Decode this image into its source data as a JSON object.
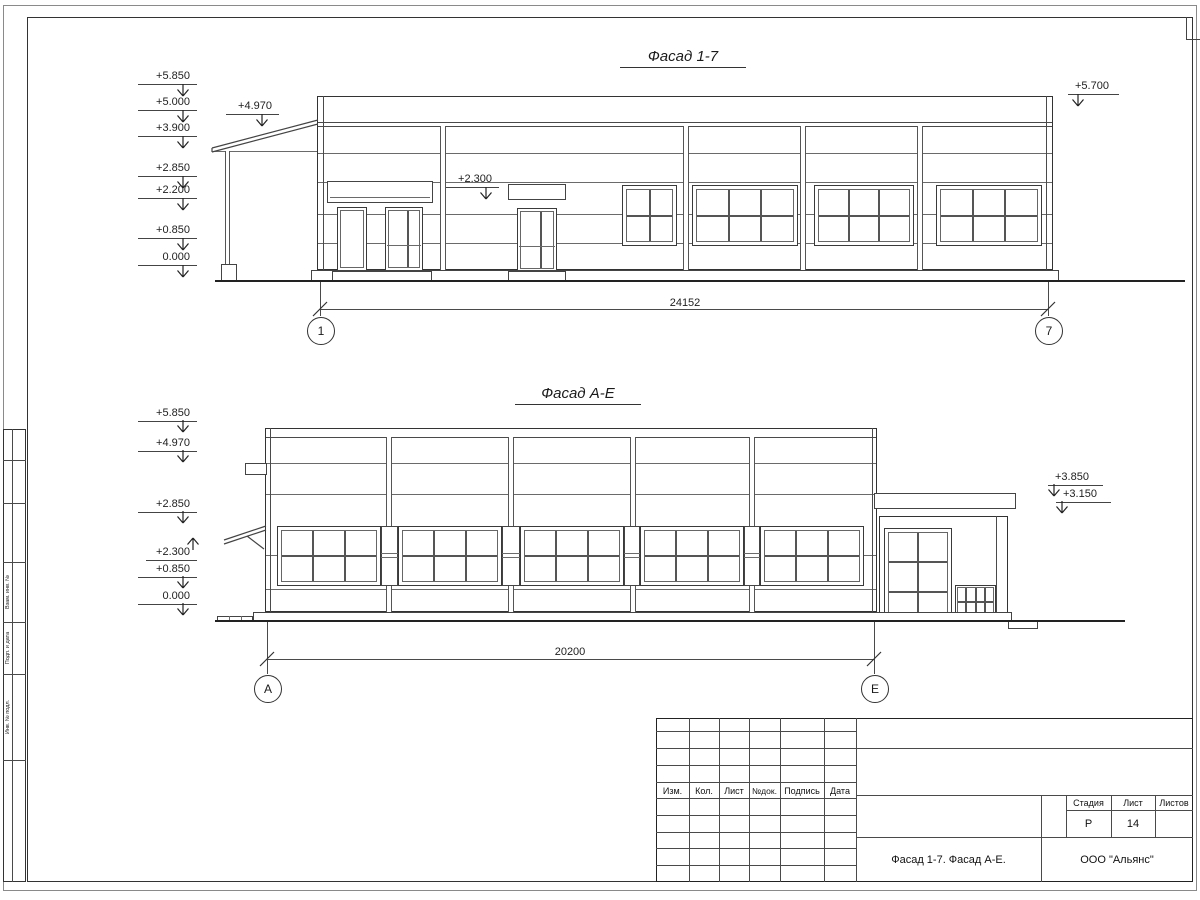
{
  "sheet": {
    "facade17": {
      "title": "Фасад 1-7",
      "dimension": "24152",
      "axis_left": "1",
      "axis_right": "7",
      "marks_left": [
        "+5.850",
        "+5.000",
        "+3.900",
        "+2.850",
        "+2.200",
        "+0.850",
        "0.000"
      ],
      "mark_canopy": "+4.970",
      "mark_sign": "+2.300",
      "mark_right": "+5.700"
    },
    "facadeAE": {
      "title": "Фасад А-Е",
      "dimension": "20200",
      "axis_left": "А",
      "axis_right": "Е",
      "marks_left": [
        "+5.850",
        "+4.970",
        "+2.850",
        "+0.850",
        "0.000"
      ],
      "mark_canopy_low": "+2.300",
      "marks_right": [
        "+3.850",
        "+3.150"
      ]
    },
    "titleblock": {
      "rev_cols": [
        "Изм.",
        "Кол.",
        "Лист",
        "№док.",
        "Подпись",
        "Дата"
      ],
      "stage_label": "Стадия",
      "sheet_label": "Лист",
      "sheets_label": "Листов",
      "stage_value": "Р",
      "sheet_value": "14",
      "drawing_name": "Фасад 1-7. Фасад А-Е.",
      "organization": "ООО \"Альянс\""
    },
    "margin_labels": [
      "Взам. инв. №",
      "Подп. и дата",
      "Инв. № подл."
    ]
  }
}
